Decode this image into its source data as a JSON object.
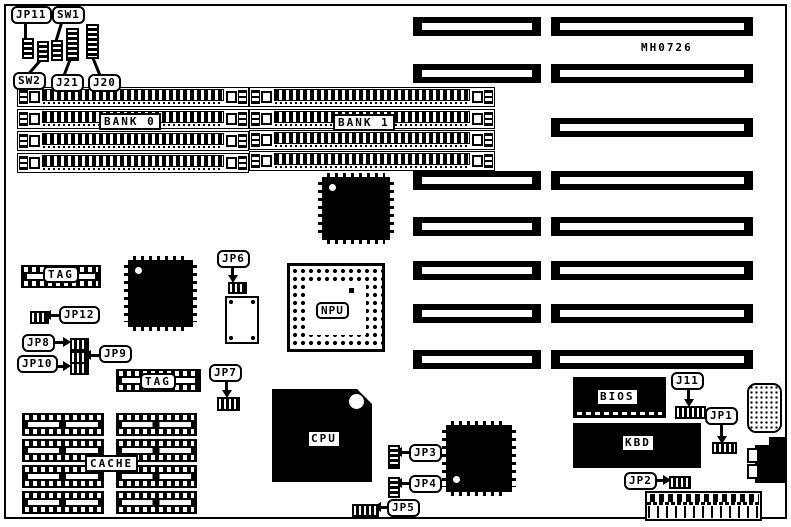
{
  "board": {
    "id_text": "MH0726"
  },
  "memory": {
    "bank0_label": "BANK 0",
    "bank1_label": "BANK 1"
  },
  "cache": {
    "label": "CACHE"
  },
  "tags": {
    "tag0_label": "TAG",
    "tag1_label": "TAG"
  },
  "chips": {
    "npu": "NPU",
    "cpu": "CPU",
    "bios": "BIOS",
    "kbd": "KBD"
  },
  "callouts": [
    {
      "id": "jp11",
      "label": "JP11"
    },
    {
      "id": "sw1",
      "label": "SW1"
    },
    {
      "id": "sw2",
      "label": "SW2"
    },
    {
      "id": "j21",
      "label": "J21"
    },
    {
      "id": "j20",
      "label": "J20"
    },
    {
      "id": "jp12",
      "label": "JP12"
    },
    {
      "id": "jp8",
      "label": "JP8"
    },
    {
      "id": "jp9",
      "label": "JP9"
    },
    {
      "id": "jp10",
      "label": "JP10"
    },
    {
      "id": "jp6",
      "label": "JP6"
    },
    {
      "id": "jp7",
      "label": "JP7"
    },
    {
      "id": "jp3",
      "label": "JP3"
    },
    {
      "id": "jp4",
      "label": "JP4"
    },
    {
      "id": "jp5",
      "label": "JP5"
    },
    {
      "id": "j11",
      "label": "J11"
    },
    {
      "id": "jp1",
      "label": "JP1"
    },
    {
      "id": "jp2",
      "label": "JP2"
    }
  ]
}
